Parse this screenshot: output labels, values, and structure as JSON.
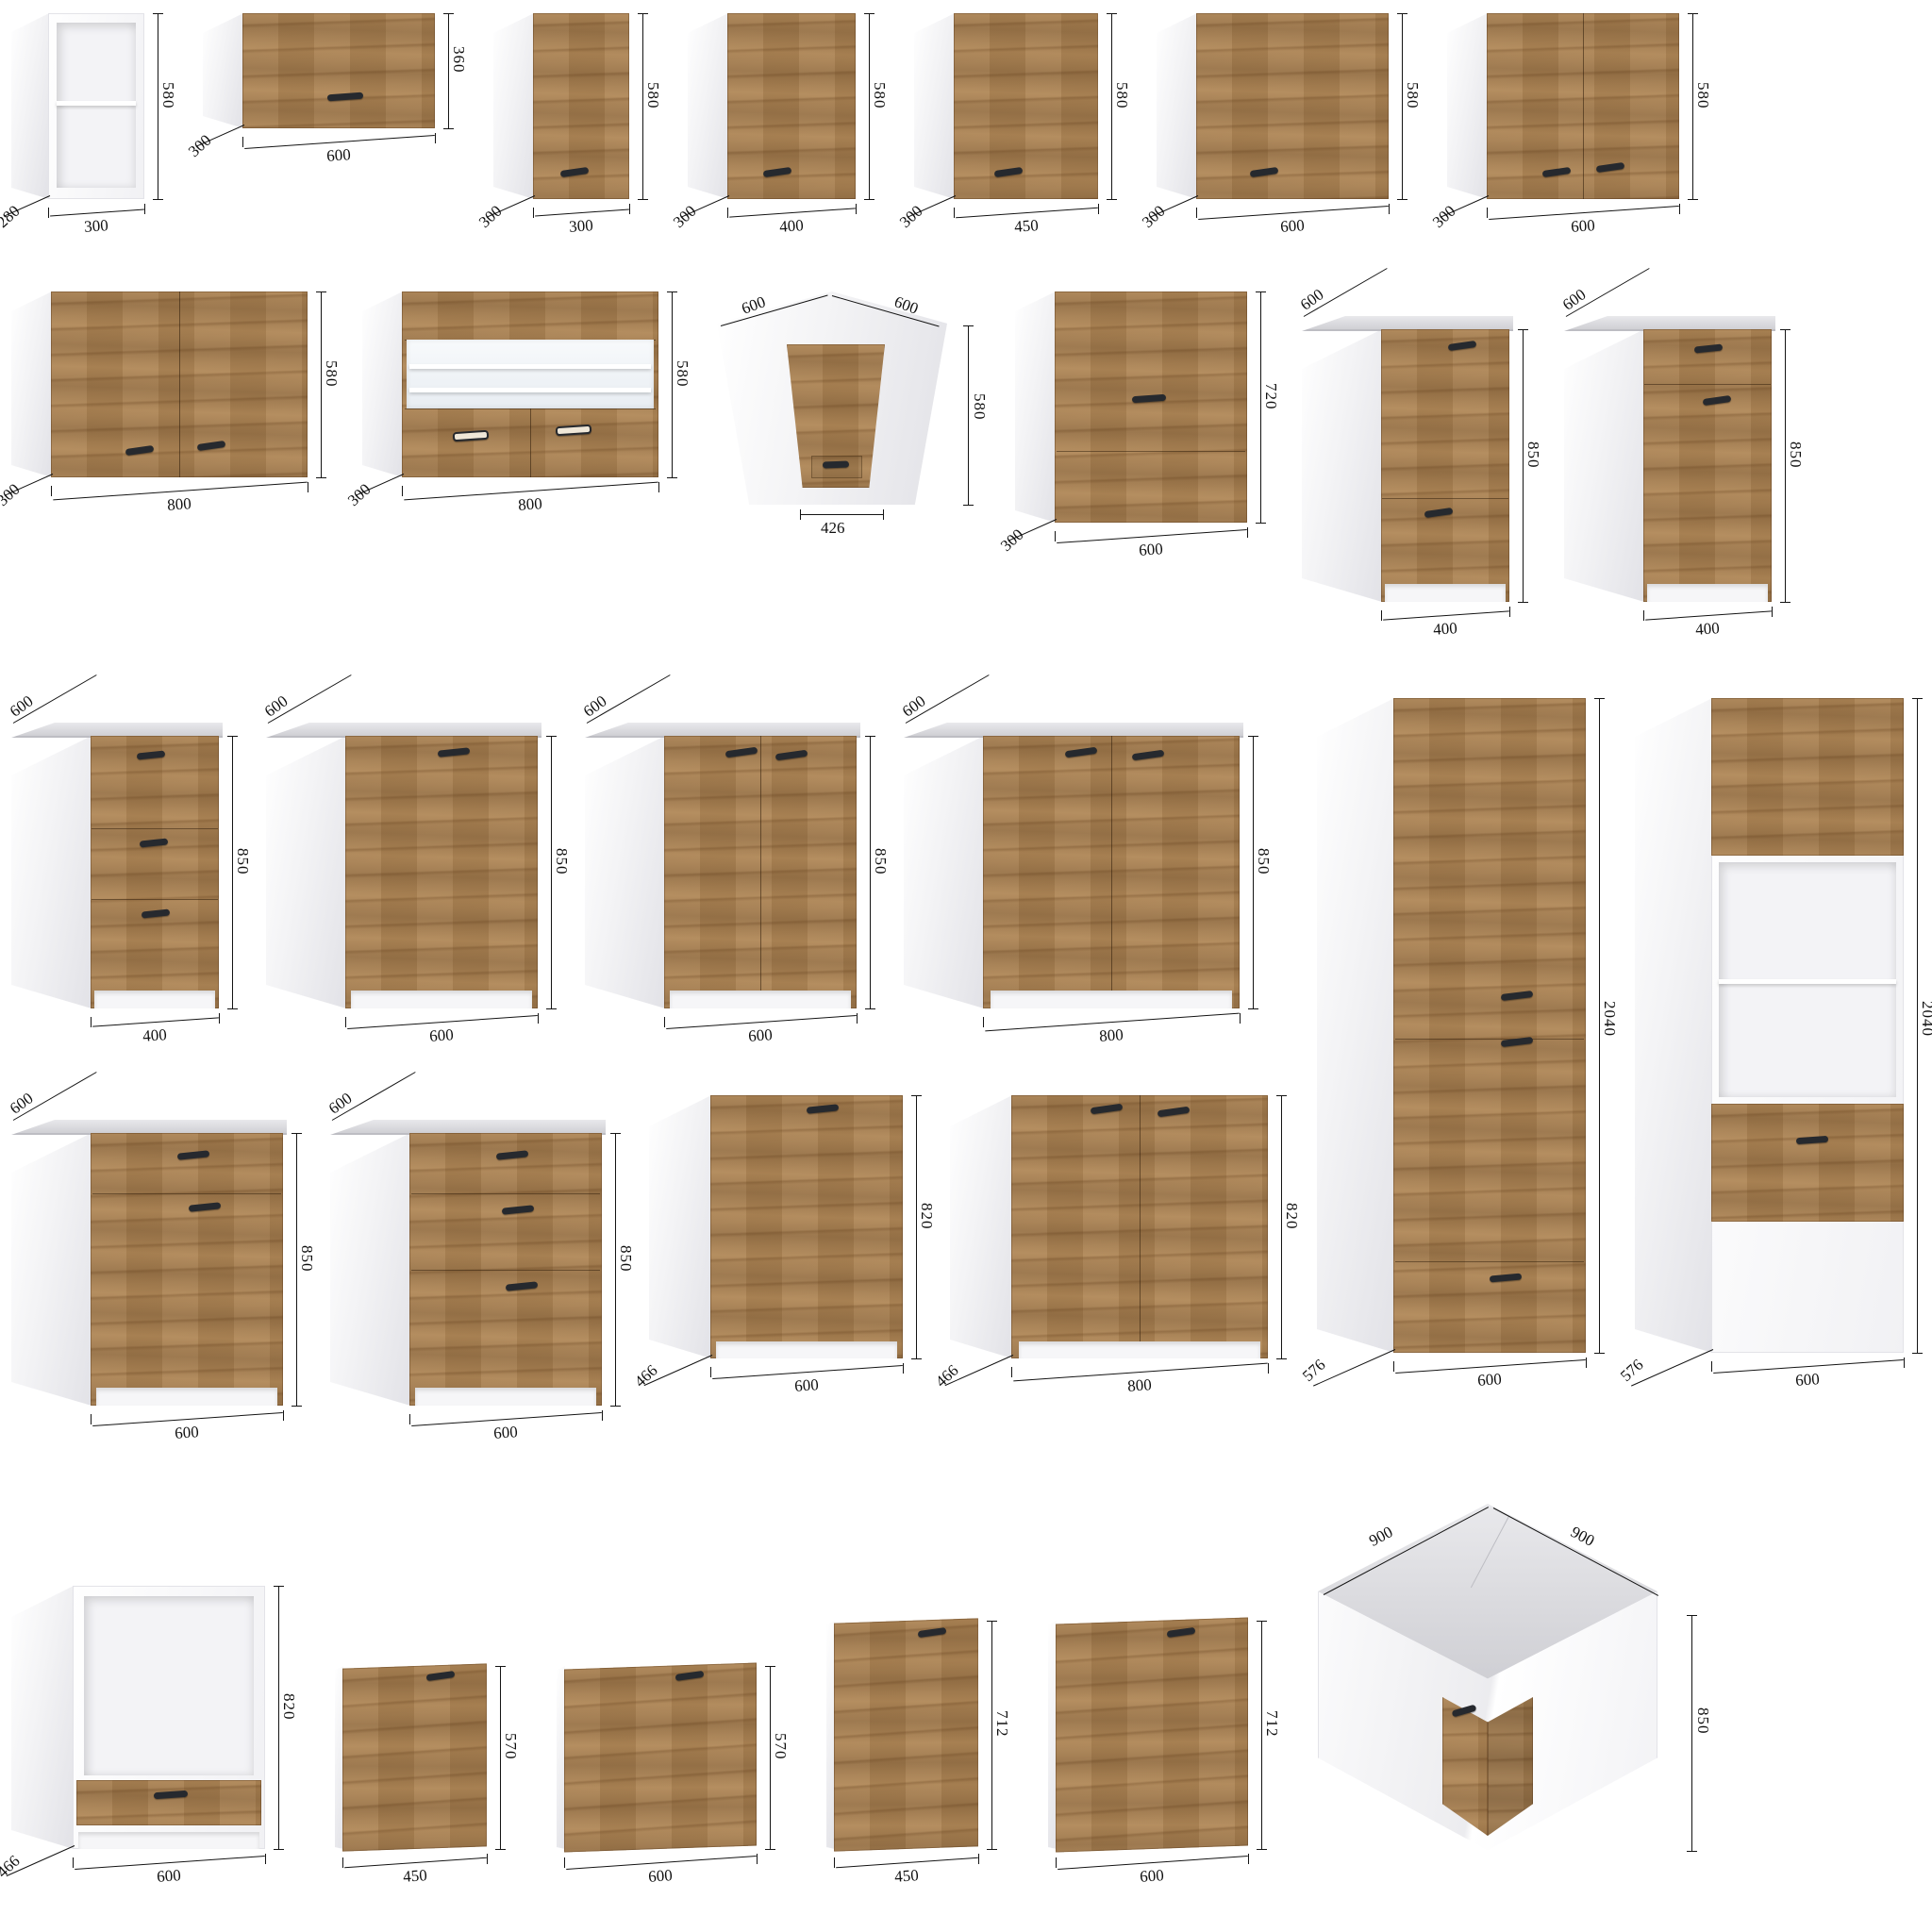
{
  "page": {
    "name": "kitchen-cabinet-dimension-sheet",
    "background": "#ffffff"
  },
  "colors": {
    "wood": "#b08756",
    "wood_dark": "#5f3c1c",
    "carcass_white": "#ffffff",
    "side_shadow": "#e2e2e7",
    "countertop": "#d9d9dc",
    "countertop_edge": "#bdbdc3",
    "handle": "#26292e",
    "dimension": "#141414",
    "niche": "#f3f3f6",
    "glass": "#eef2f5"
  },
  "rows": {
    "row1": [
      "c01",
      "c02",
      "c03",
      "c04",
      "c05",
      "c06",
      "c07"
    ],
    "row2": [
      "c08",
      "c09",
      "c10",
      "c11",
      "c12",
      "c13"
    ],
    "row3": [
      "c14",
      "c15",
      "c16",
      "c17"
    ],
    "row4": [
      "c20",
      "c21",
      "c22",
      "c23"
    ],
    "tall": [
      "c18",
      "c19"
    ],
    "row5": [
      "c24",
      "c25",
      "c26",
      "c27",
      "c28",
      "c29"
    ]
  },
  "cabinets": [
    {
      "id": "c01",
      "name": "wall-open-shelf-300x280x580",
      "kind": "open-wall",
      "width_mm": 300,
      "depth_mm": 280,
      "height_mm": 580,
      "dims": [
        {
          "t": "580",
          "p": "right"
        },
        {
          "t": "300",
          "p": "bottom"
        },
        {
          "t": "280",
          "p": "depth-bl"
        }
      ]
    },
    {
      "id": "c02",
      "name": "wall-flip-door-600x300x360",
      "kind": "flip-wall",
      "width_mm": 600,
      "depth_mm": 300,
      "height_mm": 360,
      "dims": [
        {
          "t": "360",
          "p": "right"
        },
        {
          "t": "600",
          "p": "bottom"
        },
        {
          "t": "300",
          "p": "depth-bl"
        }
      ]
    },
    {
      "id": "c03",
      "name": "wall-single-door-300x300x580",
      "kind": "door-wall",
      "width_mm": 300,
      "depth_mm": 300,
      "height_mm": 580,
      "dims": [
        {
          "t": "580",
          "p": "right"
        },
        {
          "t": "300",
          "p": "bottom"
        },
        {
          "t": "300",
          "p": "depth-bl"
        }
      ]
    },
    {
      "id": "c04",
      "name": "wall-single-door-400x300x580",
      "kind": "door-wall",
      "width_mm": 400,
      "depth_mm": 300,
      "height_mm": 580,
      "dims": [
        {
          "t": "580",
          "p": "right"
        },
        {
          "t": "400",
          "p": "bottom"
        },
        {
          "t": "300",
          "p": "depth-bl"
        }
      ]
    },
    {
      "id": "c05",
      "name": "wall-single-door-450x300x580",
      "kind": "door-wall",
      "width_mm": 450,
      "depth_mm": 300,
      "height_mm": 580,
      "dims": [
        {
          "t": "580",
          "p": "right"
        },
        {
          "t": "450",
          "p": "bottom"
        },
        {
          "t": "300",
          "p": "depth-bl"
        }
      ]
    },
    {
      "id": "c06",
      "name": "wall-single-door-600x300x580",
      "kind": "door-wall",
      "width_mm": 600,
      "depth_mm": 300,
      "height_mm": 580,
      "dims": [
        {
          "t": "580",
          "p": "right"
        },
        {
          "t": "600",
          "p": "bottom"
        },
        {
          "t": "300",
          "p": "depth-bl"
        }
      ]
    },
    {
      "id": "c07",
      "name": "wall-double-door-600x300x580",
      "kind": "2door-wall",
      "width_mm": 600,
      "depth_mm": 300,
      "height_mm": 580,
      "dims": [
        {
          "t": "580",
          "p": "right"
        },
        {
          "t": "600",
          "p": "bottom"
        },
        {
          "t": "300",
          "p": "depth-bl"
        }
      ]
    },
    {
      "id": "c08",
      "name": "wall-double-door-800x300x580",
      "kind": "2door-wall",
      "width_mm": 800,
      "depth_mm": 300,
      "height_mm": 580,
      "dims": [
        {
          "t": "580",
          "p": "right"
        },
        {
          "t": "800",
          "p": "bottom"
        },
        {
          "t": "300",
          "p": "depth-bl"
        }
      ]
    },
    {
      "id": "c09",
      "name": "wall-glass-display-800x300x580",
      "kind": "glass-wall",
      "width_mm": 800,
      "depth_mm": 300,
      "height_mm": 580,
      "dims": [
        {
          "t": "580",
          "p": "right"
        },
        {
          "t": "800",
          "p": "bottom"
        },
        {
          "t": "300",
          "p": "depth-bl"
        }
      ]
    },
    {
      "id": "c10",
      "name": "wall-corner-600x600x580-front-426",
      "kind": "corner-wall",
      "width_mm": 600,
      "depth_mm": 600,
      "height_mm": 580,
      "front_mm": 426,
      "dims": [
        {
          "t": "600",
          "p": "tl-diag"
        },
        {
          "t": "600",
          "p": "tr-diag"
        },
        {
          "t": "580",
          "p": "right"
        },
        {
          "t": "426",
          "p": "bottom"
        }
      ]
    },
    {
      "id": "c11",
      "name": "wall-double-flip-600x300x720",
      "kind": "flip2-wall",
      "width_mm": 600,
      "depth_mm": 300,
      "height_mm": 720,
      "dims": [
        {
          "t": "720",
          "p": "right"
        },
        {
          "t": "600",
          "p": "bottom"
        },
        {
          "t": "300",
          "p": "depth-bl"
        }
      ]
    },
    {
      "id": "c12",
      "name": "base-door-drawer-400x600x850",
      "kind": "base-door-400",
      "width_mm": 400,
      "depth_mm": 600,
      "height_mm": 850,
      "dims": [
        {
          "t": "600",
          "p": "depth-tl"
        },
        {
          "t": "850",
          "p": "right"
        },
        {
          "t": "400",
          "p": "bottom"
        }
      ]
    },
    {
      "id": "c13",
      "name": "base-drawer-door-400x600x850",
      "kind": "base-drawer-door-400",
      "width_mm": 400,
      "depth_mm": 600,
      "height_mm": 850,
      "dims": [
        {
          "t": "600",
          "p": "depth-tl"
        },
        {
          "t": "850",
          "p": "right"
        },
        {
          "t": "400",
          "p": "bottom"
        }
      ]
    },
    {
      "id": "c14",
      "name": "base-three-drawer-400x600x850",
      "kind": "base-3drawer-400",
      "width_mm": 400,
      "depth_mm": 600,
      "height_mm": 850,
      "dims": [
        {
          "t": "600",
          "p": "depth-tl"
        },
        {
          "t": "850",
          "p": "right"
        },
        {
          "t": "400",
          "p": "bottom"
        }
      ]
    },
    {
      "id": "c15",
      "name": "base-single-door-600x600x850",
      "kind": "base-door-600",
      "width_mm": 600,
      "depth_mm": 600,
      "height_mm": 850,
      "dims": [
        {
          "t": "600",
          "p": "depth-tl"
        },
        {
          "t": "850",
          "p": "right"
        },
        {
          "t": "600",
          "p": "bottom"
        }
      ]
    },
    {
      "id": "c16",
      "name": "base-double-door-600x600x850",
      "kind": "base-2door",
      "width_mm": 600,
      "depth_mm": 600,
      "height_mm": 850,
      "dims": [
        {
          "t": "600",
          "p": "depth-tl"
        },
        {
          "t": "850",
          "p": "right"
        },
        {
          "t": "600",
          "p": "bottom"
        }
      ]
    },
    {
      "id": "c17",
      "name": "base-double-door-800x600x850",
      "kind": "base-2door",
      "width_mm": 800,
      "depth_mm": 600,
      "height_mm": 850,
      "dims": [
        {
          "t": "600",
          "p": "depth-tl"
        },
        {
          "t": "850",
          "p": "right"
        },
        {
          "t": "800",
          "p": "bottom"
        }
      ]
    },
    {
      "id": "c18",
      "name": "tall-pantry-600x576x2040",
      "kind": "tall",
      "width_mm": 600,
      "depth_mm": 576,
      "height_mm": 2040,
      "dims": [
        {
          "t": "2040",
          "p": "right"
        },
        {
          "t": "600",
          "p": "bottom"
        },
        {
          "t": "576",
          "p": "depth-bl"
        }
      ]
    },
    {
      "id": "c19",
      "name": "tall-oven-housing-600x576x2040",
      "kind": "tall-oven",
      "width_mm": 600,
      "depth_mm": 576,
      "height_mm": 2040,
      "dims": [
        {
          "t": "2040",
          "p": "right"
        },
        {
          "t": "600",
          "p": "bottom"
        },
        {
          "t": "576",
          "p": "depth-bl"
        }
      ]
    },
    {
      "id": "c20",
      "name": "base-drawer-door-600x600x850",
      "kind": "base-drawer-door-600",
      "width_mm": 600,
      "depth_mm": 600,
      "height_mm": 850,
      "dims": [
        {
          "t": "600",
          "p": "depth-tl"
        },
        {
          "t": "850",
          "p": "right"
        },
        {
          "t": "600",
          "p": "bottom"
        }
      ]
    },
    {
      "id": "c21",
      "name": "base-three-drawer-600x600x850",
      "kind": "base-3drawer-600",
      "width_mm": 600,
      "depth_mm": 600,
      "height_mm": 850,
      "dims": [
        {
          "t": "600",
          "p": "depth-tl"
        },
        {
          "t": "850",
          "p": "right"
        },
        {
          "t": "600",
          "p": "bottom"
        }
      ]
    },
    {
      "id": "c22",
      "name": "base-single-door-600x466x820",
      "kind": "base-door-nc",
      "width_mm": 600,
      "depth_mm": 466,
      "height_mm": 820,
      "dims": [
        {
          "t": "820",
          "p": "right"
        },
        {
          "t": "600",
          "p": "bottom"
        },
        {
          "t": "466",
          "p": "depth-bl"
        }
      ]
    },
    {
      "id": "c23",
      "name": "base-double-door-800x466x820",
      "kind": "base-2door-nc",
      "width_mm": 800,
      "depth_mm": 466,
      "height_mm": 820,
      "dims": [
        {
          "t": "820",
          "p": "right"
        },
        {
          "t": "800",
          "p": "bottom"
        },
        {
          "t": "466",
          "p": "depth-bl"
        }
      ]
    },
    {
      "id": "c24",
      "name": "oven-housing-base-600x466x820",
      "kind": "oven-housing",
      "width_mm": 600,
      "depth_mm": 466,
      "height_mm": 820,
      "dims": [
        {
          "t": "820",
          "p": "right"
        },
        {
          "t": "600",
          "p": "bottom"
        },
        {
          "t": "466",
          "p": "depth-bl"
        }
      ]
    },
    {
      "id": "c25",
      "name": "front-panel-450x570",
      "kind": "panel",
      "width_mm": 450,
      "height_mm": 570,
      "dims": [
        {
          "t": "570",
          "p": "right"
        },
        {
          "t": "450",
          "p": "bottom"
        }
      ]
    },
    {
      "id": "c26",
      "name": "front-panel-600x570",
      "kind": "panel",
      "width_mm": 600,
      "height_mm": 570,
      "dims": [
        {
          "t": "570",
          "p": "right"
        },
        {
          "t": "600",
          "p": "bottom"
        }
      ]
    },
    {
      "id": "c27",
      "name": "front-panel-450x712",
      "kind": "panel",
      "width_mm": 450,
      "height_mm": 712,
      "dims": [
        {
          "t": "712",
          "p": "right"
        },
        {
          "t": "450",
          "p": "bottom"
        }
      ]
    },
    {
      "id": "c28",
      "name": "front-panel-600x712",
      "kind": "panel",
      "width_mm": 600,
      "height_mm": 712,
      "dims": [
        {
          "t": "712",
          "p": "right"
        },
        {
          "t": "600",
          "p": "bottom"
        }
      ]
    },
    {
      "id": "c29",
      "name": "base-corner-900x900x850",
      "kind": "corner-base",
      "width_mm": 900,
      "depth_mm": 900,
      "height_mm": 850,
      "dims": [
        {
          "t": "900",
          "p": "tl-diag"
        },
        {
          "t": "900",
          "p": "tr-diag"
        },
        {
          "t": "850",
          "p": "right"
        }
      ]
    }
  ]
}
